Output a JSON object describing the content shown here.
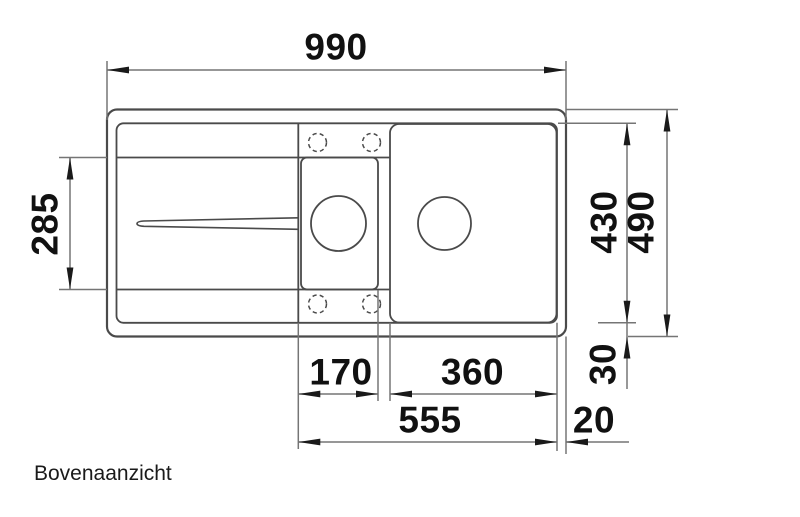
{
  "caption": "Bovenaanzicht",
  "dimensions": {
    "overall_width": "990",
    "drainboard_depth": "285",
    "basin_area_depth": "430",
    "overall_depth": "490",
    "small_bowl_width": "170",
    "main_bowl_width": "360",
    "bowl_zone_width": "555",
    "right_rim_width": "20",
    "rim_depth": "30"
  },
  "colors": {
    "outline": "#4a4a4a",
    "dimension_line": "#757575",
    "annotation": "#111111",
    "background": "#ffffff"
  }
}
